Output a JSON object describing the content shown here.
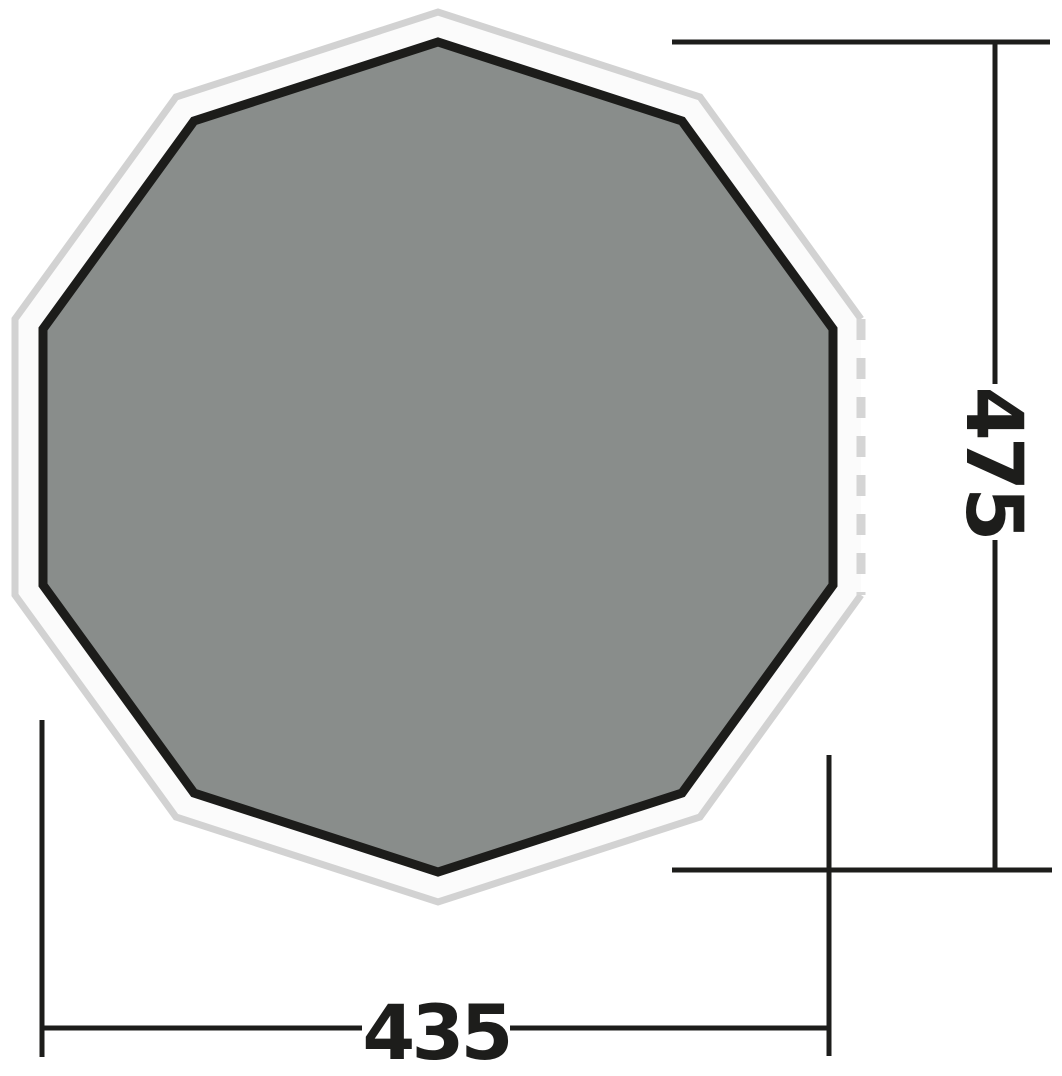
{
  "diagram": {
    "shape": "decagon",
    "dimensions": {
      "height": {
        "value": "475",
        "orientation": "vertical"
      },
      "width": {
        "value": "435",
        "orientation": "horizontal"
      }
    },
    "colors": {
      "background": "#ffffff",
      "outer_fill": "#fbfbfb",
      "outer_stroke": "#d2d2d2",
      "dashed_stroke": "#d5d5d5",
      "inner_fill": "#898d8b",
      "inner_stroke": "#1c1c1a",
      "dimension_color": "#1d1d1b"
    }
  }
}
